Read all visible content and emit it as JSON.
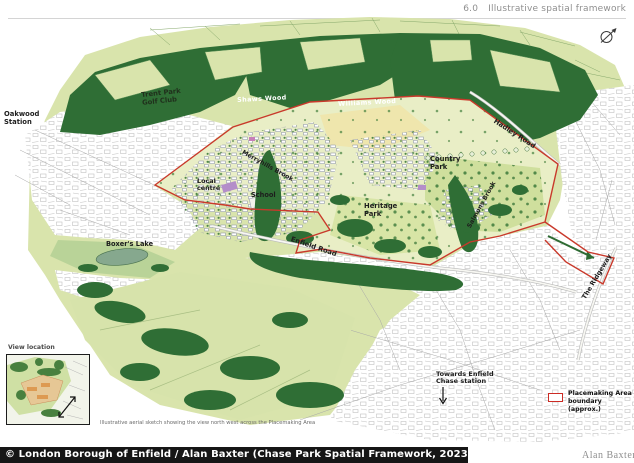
{
  "header": {
    "section": "6.0",
    "title": "Illustrative spatial framework"
  },
  "map_labels": {
    "oakwood_station": "Oakwood Station",
    "trent_park_golf_club": "Trent Park Golf Club",
    "shaws_wood": "Shaws Wood",
    "williams_wood": "Williams Wood",
    "hadley_road": "Hadley Road",
    "country_park": "Country Park",
    "merryhills_brook": "Merryhills Brook",
    "local_centre": "Local centre",
    "school": "School",
    "heritage_park": "Heritage Park",
    "salmons_brook": "Salmons Brook",
    "boxers_lake": "Boxer's Lake",
    "enfield_road": "Enfield Road",
    "the_ridgeway": "The Ridgeway",
    "towards_station": "Towards Enfield Chase station"
  },
  "inset": {
    "title": "View location"
  },
  "caption": "Illustrative aerial sketch showing the view north west across the Placemaking Area",
  "legend": {
    "label": "Placemaking Area boundary (approx.)"
  },
  "footer": {
    "copyright": "© London Borough of Enfield / Alan Baxter (Chase Park Spatial Framework, 2023)",
    "logo": "Alan Baxter"
  },
  "colors": {
    "boundary": "#c9392b",
    "woodland": "#2f6e35",
    "fields": "#d9e4ac",
    "pale_fields": "#e9eec6",
    "footer_bar": "#161616"
  }
}
